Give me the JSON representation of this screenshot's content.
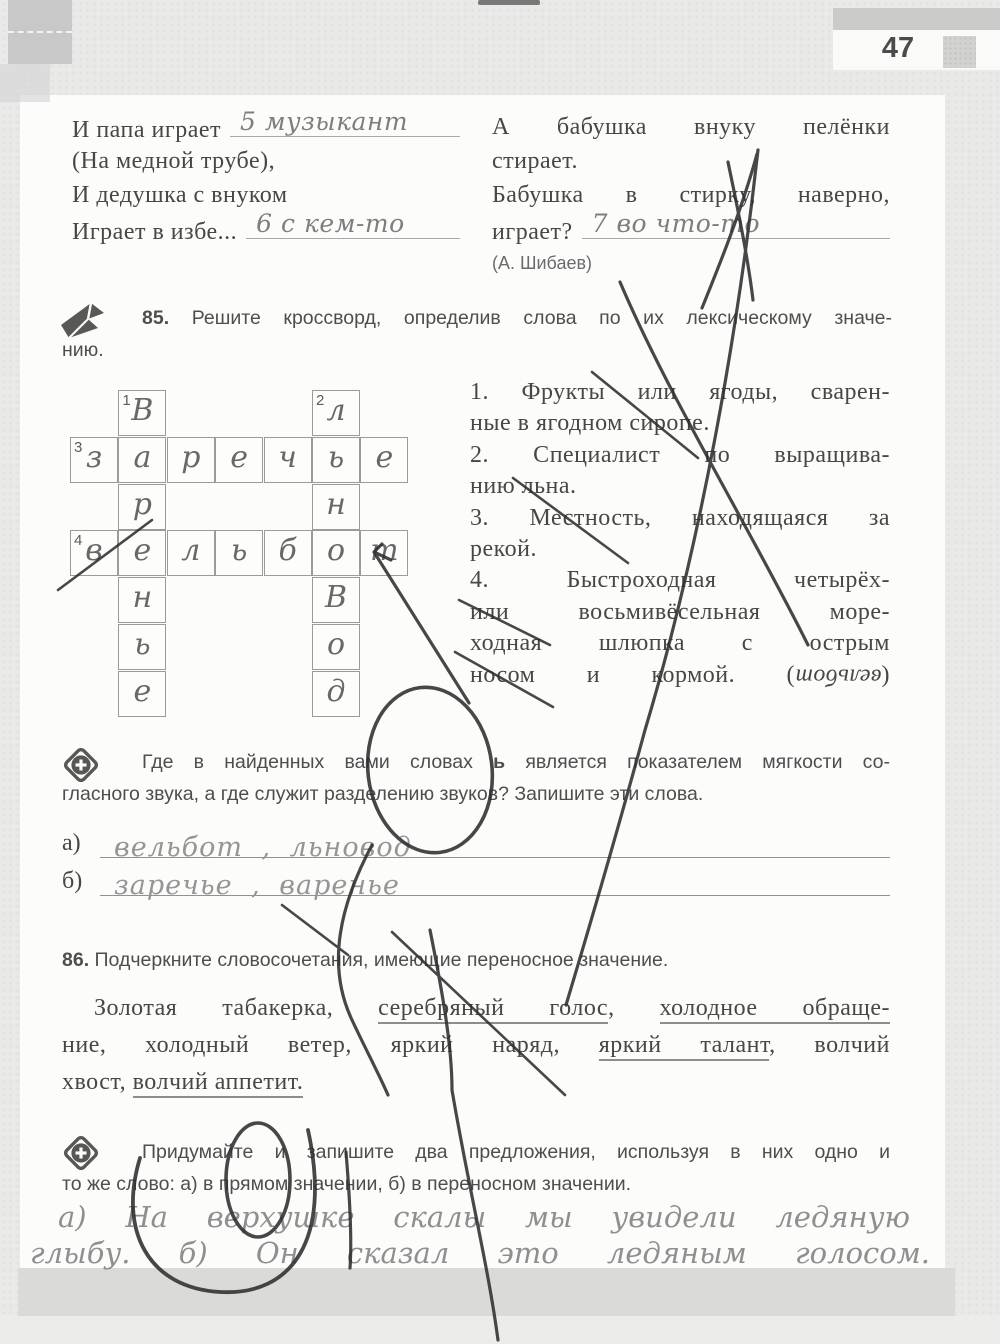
{
  "page": {
    "number": "47"
  },
  "poem": {
    "left_lines": [
      {
        "text": "И папа играет",
        "blank": "5 музыкант"
      },
      {
        "text": "(На медной трубе),"
      },
      {
        "text": "И дедушка с внуком"
      },
      {
        "text": "Играет в избе...",
        "blank": "6 с кем-то"
      }
    ],
    "right_lines": [
      {
        "text": "А бабушка внуку пелёнки",
        "fill": true
      },
      {
        "text": "стирает."
      },
      {
        "text": "Бабушка в стирку, наверно,",
        "fill": true
      },
      {
        "text": "играет?",
        "blank": "7 во что-то"
      }
    ],
    "author": "(А. Шибаев)"
  },
  "exercise85": {
    "header_lines": [
      {
        "segments": [
          {
            "text": "85. ",
            "b": true
          },
          {
            "text": "Решите кроссворд, определив слова по их лексическому значе-"
          }
        ],
        "fill": true,
        "ind": true
      },
      {
        "text": "нию."
      }
    ],
    "clues": [
      {
        "text": "1. Фрукты или ягоды, сварен-",
        "fill": true
      },
      {
        "text": "ные в ягодном сиропе."
      },
      {
        "text": "2. Специалист по выращива-",
        "fill": true
      },
      {
        "text": "нию льна."
      },
      {
        "text": "3. Местность, находящаяся за",
        "fill": true
      },
      {
        "text": "рекой."
      },
      {
        "text": "4. Быстроходная четырёх-",
        "fill": true
      },
      {
        "text": "или восьмивёсельная море-",
        "fill": true
      },
      {
        "text": "ходная шлюпка с острым",
        "fill": true
      },
      {
        "segments": [
          {
            "text": "носом и кормой. ("
          },
          {
            "text": "вельбот",
            "flip": true
          },
          {
            "text": ")"
          }
        ],
        "fill": true
      }
    ],
    "crossword": {
      "rows": 7,
      "cols": 7,
      "cells": [
        {
          "r": 0,
          "c": 1,
          "l": "В",
          "n": "1"
        },
        {
          "r": 0,
          "c": 5,
          "l": "л",
          "n": "2"
        },
        {
          "r": 1,
          "c": 0,
          "l": "з",
          "n": "3"
        },
        {
          "r": 1,
          "c": 1,
          "l": "а"
        },
        {
          "r": 1,
          "c": 2,
          "l": "р"
        },
        {
          "r": 1,
          "c": 3,
          "l": "е"
        },
        {
          "r": 1,
          "c": 4,
          "l": "ч"
        },
        {
          "r": 1,
          "c": 5,
          "l": "ь"
        },
        {
          "r": 1,
          "c": 6,
          "l": "е"
        },
        {
          "r": 2,
          "c": 1,
          "l": "р"
        },
        {
          "r": 2,
          "c": 5,
          "l": "н"
        },
        {
          "r": 3,
          "c": 0,
          "l": "в",
          "n": "4"
        },
        {
          "r": 3,
          "c": 1,
          "l": "е"
        },
        {
          "r": 3,
          "c": 2,
          "l": "л"
        },
        {
          "r": 3,
          "c": 3,
          "l": "ь"
        },
        {
          "r": 3,
          "c": 4,
          "l": "б"
        },
        {
          "r": 3,
          "c": 5,
          "l": "о"
        },
        {
          "r": 3,
          "c": 6,
          "l": "т"
        },
        {
          "r": 4,
          "c": 1,
          "l": "н"
        },
        {
          "r": 4,
          "c": 5,
          "l": "В"
        },
        {
          "r": 5,
          "c": 1,
          "l": "ь"
        },
        {
          "r": 5,
          "c": 5,
          "l": "о"
        },
        {
          "r": 6,
          "c": 1,
          "l": "е"
        },
        {
          "r": 6,
          "c": 5,
          "l": "д"
        }
      ]
    }
  },
  "task_soft_sign": {
    "lines": [
      {
        "segments": [
          {
            "text": "Где в найденных вами словах "
          },
          {
            "text": "ь",
            "b": true
          },
          {
            "text": " является показателем мягкости со-"
          }
        ],
        "fill": true,
        "ind": true
      },
      {
        "text": "гласного звука, а где служит разделению звуков? Запишите эти слова."
      }
    ],
    "answers": [
      {
        "label": "а)",
        "handwritten": "вельбот ,  льновод"
      },
      {
        "label": "б)",
        "handwritten": "заречье , варенье"
      }
    ]
  },
  "exercise86": {
    "header": {
      "segments": [
        {
          "text": "86. ",
          "b": true
        },
        {
          "text": "Подчеркните словосочетания, имеющие переносное значение."
        }
      ]
    },
    "body_lines": [
      {
        "segments": [
          {
            "text": "Золотая табакерка, "
          },
          {
            "text": "серебряный голос",
            "u": true
          },
          {
            "text": ", "
          },
          {
            "text": "холодное обраще-",
            "u": true
          }
        ],
        "fill": true,
        "ind86": true
      },
      {
        "segments": [
          {
            "text": "ние, холодный ветер, яркий наряд, "
          },
          {
            "text": "яркий талант",
            "u": true
          },
          {
            "text": ", волчий"
          }
        ],
        "fill": true
      },
      {
        "segments": [
          {
            "text": "хвост, "
          },
          {
            "text": "волчий аппетит.",
            "u": true
          }
        ]
      }
    ]
  },
  "task_sentences": {
    "lines": [
      {
        "text": "Придумайте и запишите два предложения, используя в них одно и",
        "fill": true,
        "ind": true
      },
      {
        "text": "то же слово: а) в прямом значении, б) в переносном значении."
      }
    ],
    "handwritten_line1": "а) На верхушке скалы мы увидели ледяную",
    "handwritten_line2": "глыбу. б) Он сказал это ледяным голосом."
  }
}
